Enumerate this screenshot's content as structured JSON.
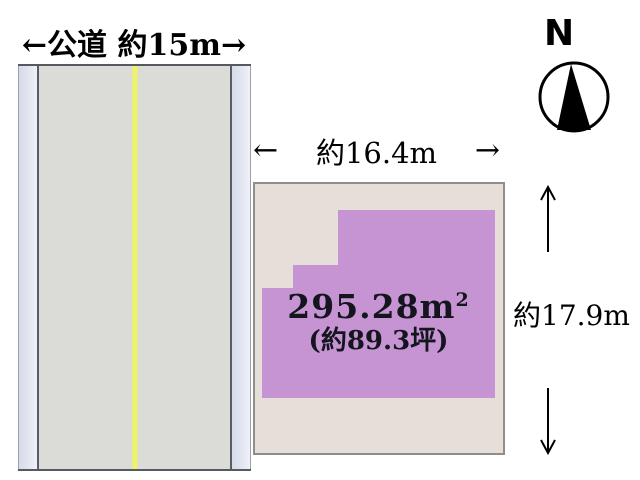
{
  "road": {
    "label": "←公道 約15m→"
  },
  "parcel": {
    "width_label": "約16.4m",
    "height_label": "約17.9m",
    "area_value": "295.28m",
    "area_exponent": "2",
    "area_tsubo_label": "(約89.3坪)"
  },
  "dimension_arrows": {
    "left": "←",
    "right": "→"
  },
  "compass": {
    "north_label": "N"
  },
  "colors": {
    "road_surface": "#dbdcd8",
    "sidewalk_fill": "#e2e5f0",
    "center_line": "#edf566",
    "plot_background": "#e5ded9",
    "parcel_fill": "#c694d3"
  }
}
